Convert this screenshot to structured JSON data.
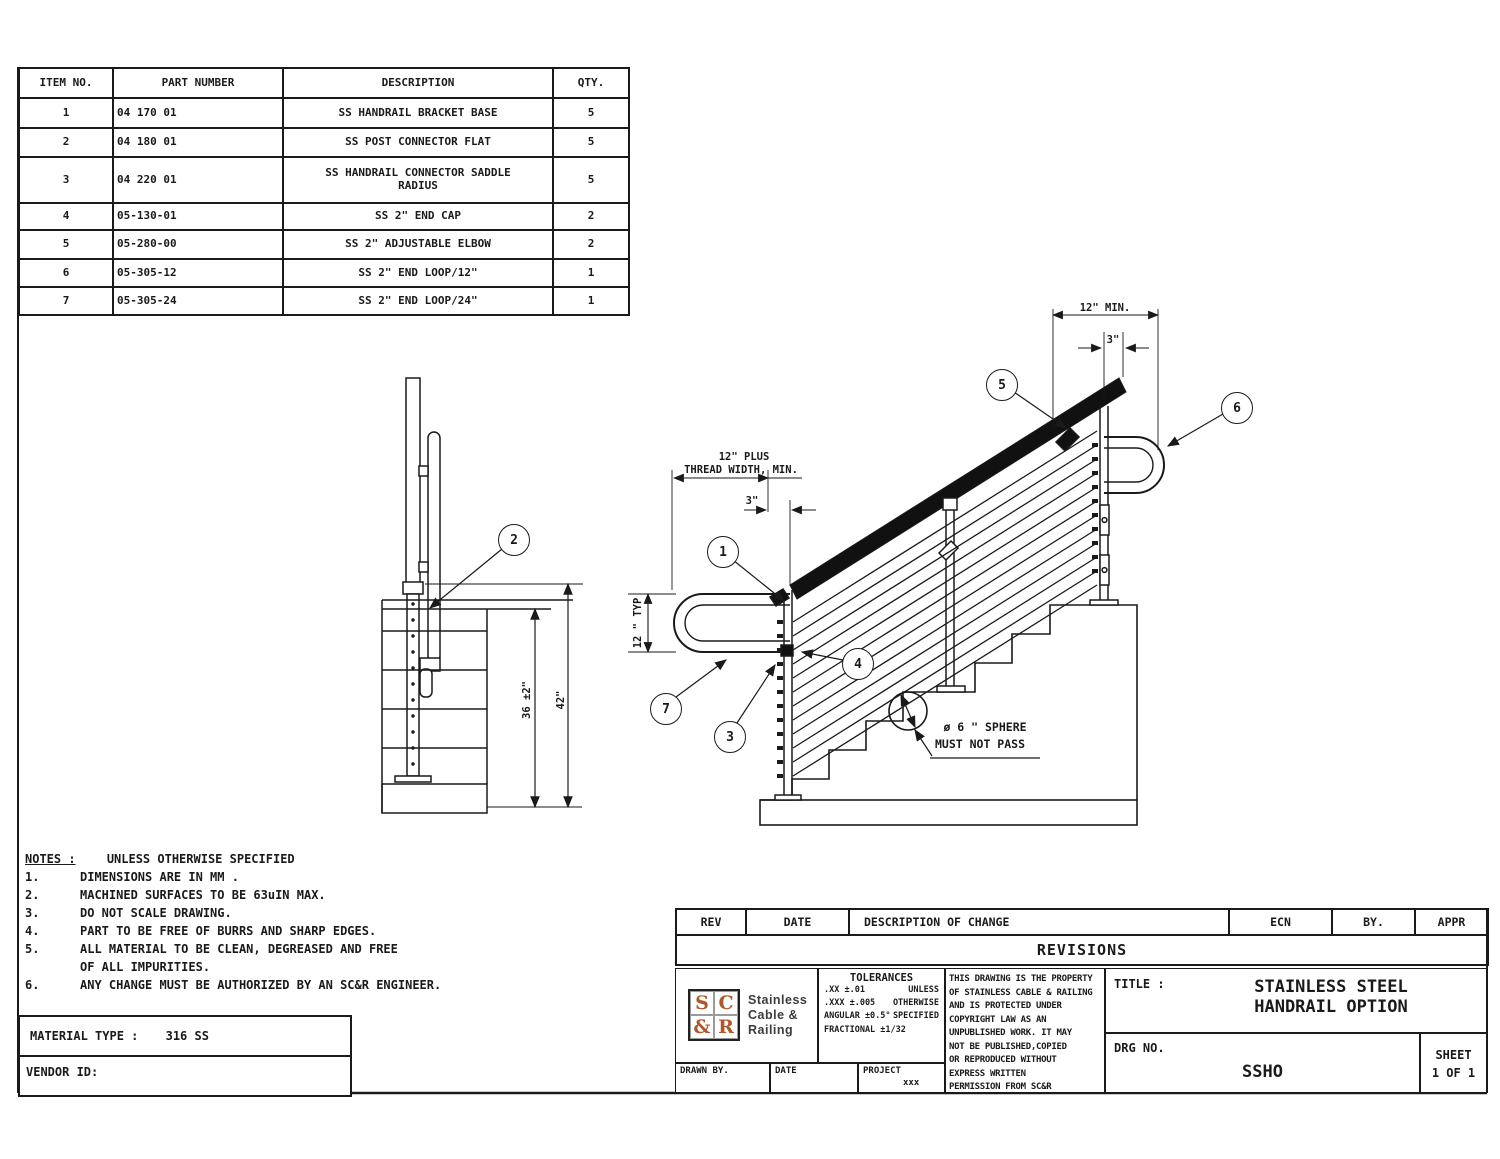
{
  "parts_table": {
    "headers": [
      "ITEM NO.",
      "PART NUMBER",
      "DESCRIPTION",
      "QTY."
    ],
    "rows": [
      {
        "item": "1",
        "part": "04 170 01",
        "desc": "SS HANDRAIL BRACKET BASE",
        "qty": "5"
      },
      {
        "item": "2",
        "part": "04 180 01",
        "desc": "SS POST CONNECTOR FLAT",
        "qty": "5"
      },
      {
        "item": "3",
        "part": "04 220 01",
        "desc": "SS HANDRAIL CONNECTOR SADDLE RADIUS",
        "qty": "5"
      },
      {
        "item": "4",
        "part": "05-130-01",
        "desc": "SS 2\" END CAP",
        "qty": "2"
      },
      {
        "item": "5",
        "part": "05-280-00",
        "desc": "SS 2\" ADJUSTABLE ELBOW",
        "qty": "2"
      },
      {
        "item": "6",
        "part": "05-305-12",
        "desc": "SS 2\" END LOOP/12\"",
        "qty": "1"
      },
      {
        "item": "7",
        "part": "05-305-24",
        "desc": "SS 2\" END LOOP/24\"",
        "qty": "1"
      }
    ]
  },
  "notes": {
    "title": "NOTES :",
    "subtitle": "UNLESS OTHERWISE SPECIFIED",
    "items": [
      {
        "num": "1.",
        "text": "DIMENSIONS ARE IN MM ."
      },
      {
        "num": "2.",
        "text": "MACHINED SURFACES TO BE 63uIN MAX."
      },
      {
        "num": "3.",
        "text": "DO NOT SCALE DRAWING."
      },
      {
        "num": "4.",
        "text": "PART TO BE FREE OF BURRS AND SHARP EDGES."
      },
      {
        "num": "5.",
        "text": "ALL MATERIAL TO BE CLEAN, DEGREASED AND FREE"
      },
      {
        "num": "",
        "text": "OF ALL IMPURITIES."
      },
      {
        "num": "6.",
        "text": "ANY CHANGE MUST BE AUTHORIZED BY AN SC&R ENGINEER."
      }
    ]
  },
  "material_box": {
    "label": "MATERIAL TYPE :",
    "value": "316 SS"
  },
  "vendor_box": {
    "label": "VENDOR ID:"
  },
  "revisions": {
    "headers": [
      "REV",
      "DATE",
      "DESCRIPTION OF CHANGE",
      "ECN",
      "BY.",
      "APPR"
    ],
    "title": "REVISIONS"
  },
  "title_block": {
    "logo": {
      "l1": "S",
      "l2": "C",
      "l3": "&",
      "l4": "R",
      "text1": "Stainless",
      "text2": "Cable &",
      "text3": "Railing",
      "color": "#b0572a"
    },
    "tolerances": {
      "title": "TOLERANCES",
      "rows": [
        [
          ".XX ±.01",
          "UNLESS"
        ],
        [
          ".XXX ±.005",
          "OTHERWISE"
        ],
        [
          "ANGULAR ±0.5°",
          "SPECIFIED"
        ],
        [
          "FRACTIONAL ±1/32",
          ""
        ]
      ]
    },
    "copyright_lines": [
      "THIS DRAWING IS THE PROPERTY",
      "OF STAINLESS CABLE & RAILING",
      "AND IS PROTECTED UNDER",
      "COPYRIGHT LAW AS AN",
      "UNPUBLISHED WORK. IT MAY",
      "NOT BE PUBLISHED,COPIED",
      "OR REPRODUCED WITHOUT",
      "EXPRESS WRITTEN",
      "PERMISSION FROM SC&R"
    ],
    "title_label": "TITLE :",
    "title_line1": "STAINLESS STEEL",
    "title_line2": "HANDRAIL OPTION",
    "drg_label": "DRG NO.",
    "drg_value": "SSHO",
    "sheet_label": "SHEET",
    "sheet_value": "1 OF 1",
    "drawn_by_label": "DRAWN BY.",
    "date_label": "DATE",
    "project_label": "PROJECT",
    "project_value": "xxx"
  },
  "annotations": {
    "balloons": [
      "1",
      "2",
      "3",
      "4",
      "5",
      "6",
      "7"
    ],
    "dims": {
      "d12min": "12\" MIN.",
      "d3top": "3\"",
      "d12plus_1": "12\" PLUS",
      "d12plus_2": "THREAD WIDTH, MIN.",
      "d3bot": "3\"",
      "d12typ": "12 \" TYP",
      "h36": "36 ±2\"",
      "h42": "42\""
    },
    "sphere_note_1": "ø 6 \" SPHERE",
    "sphere_note_2": "MUST NOT PASS"
  }
}
